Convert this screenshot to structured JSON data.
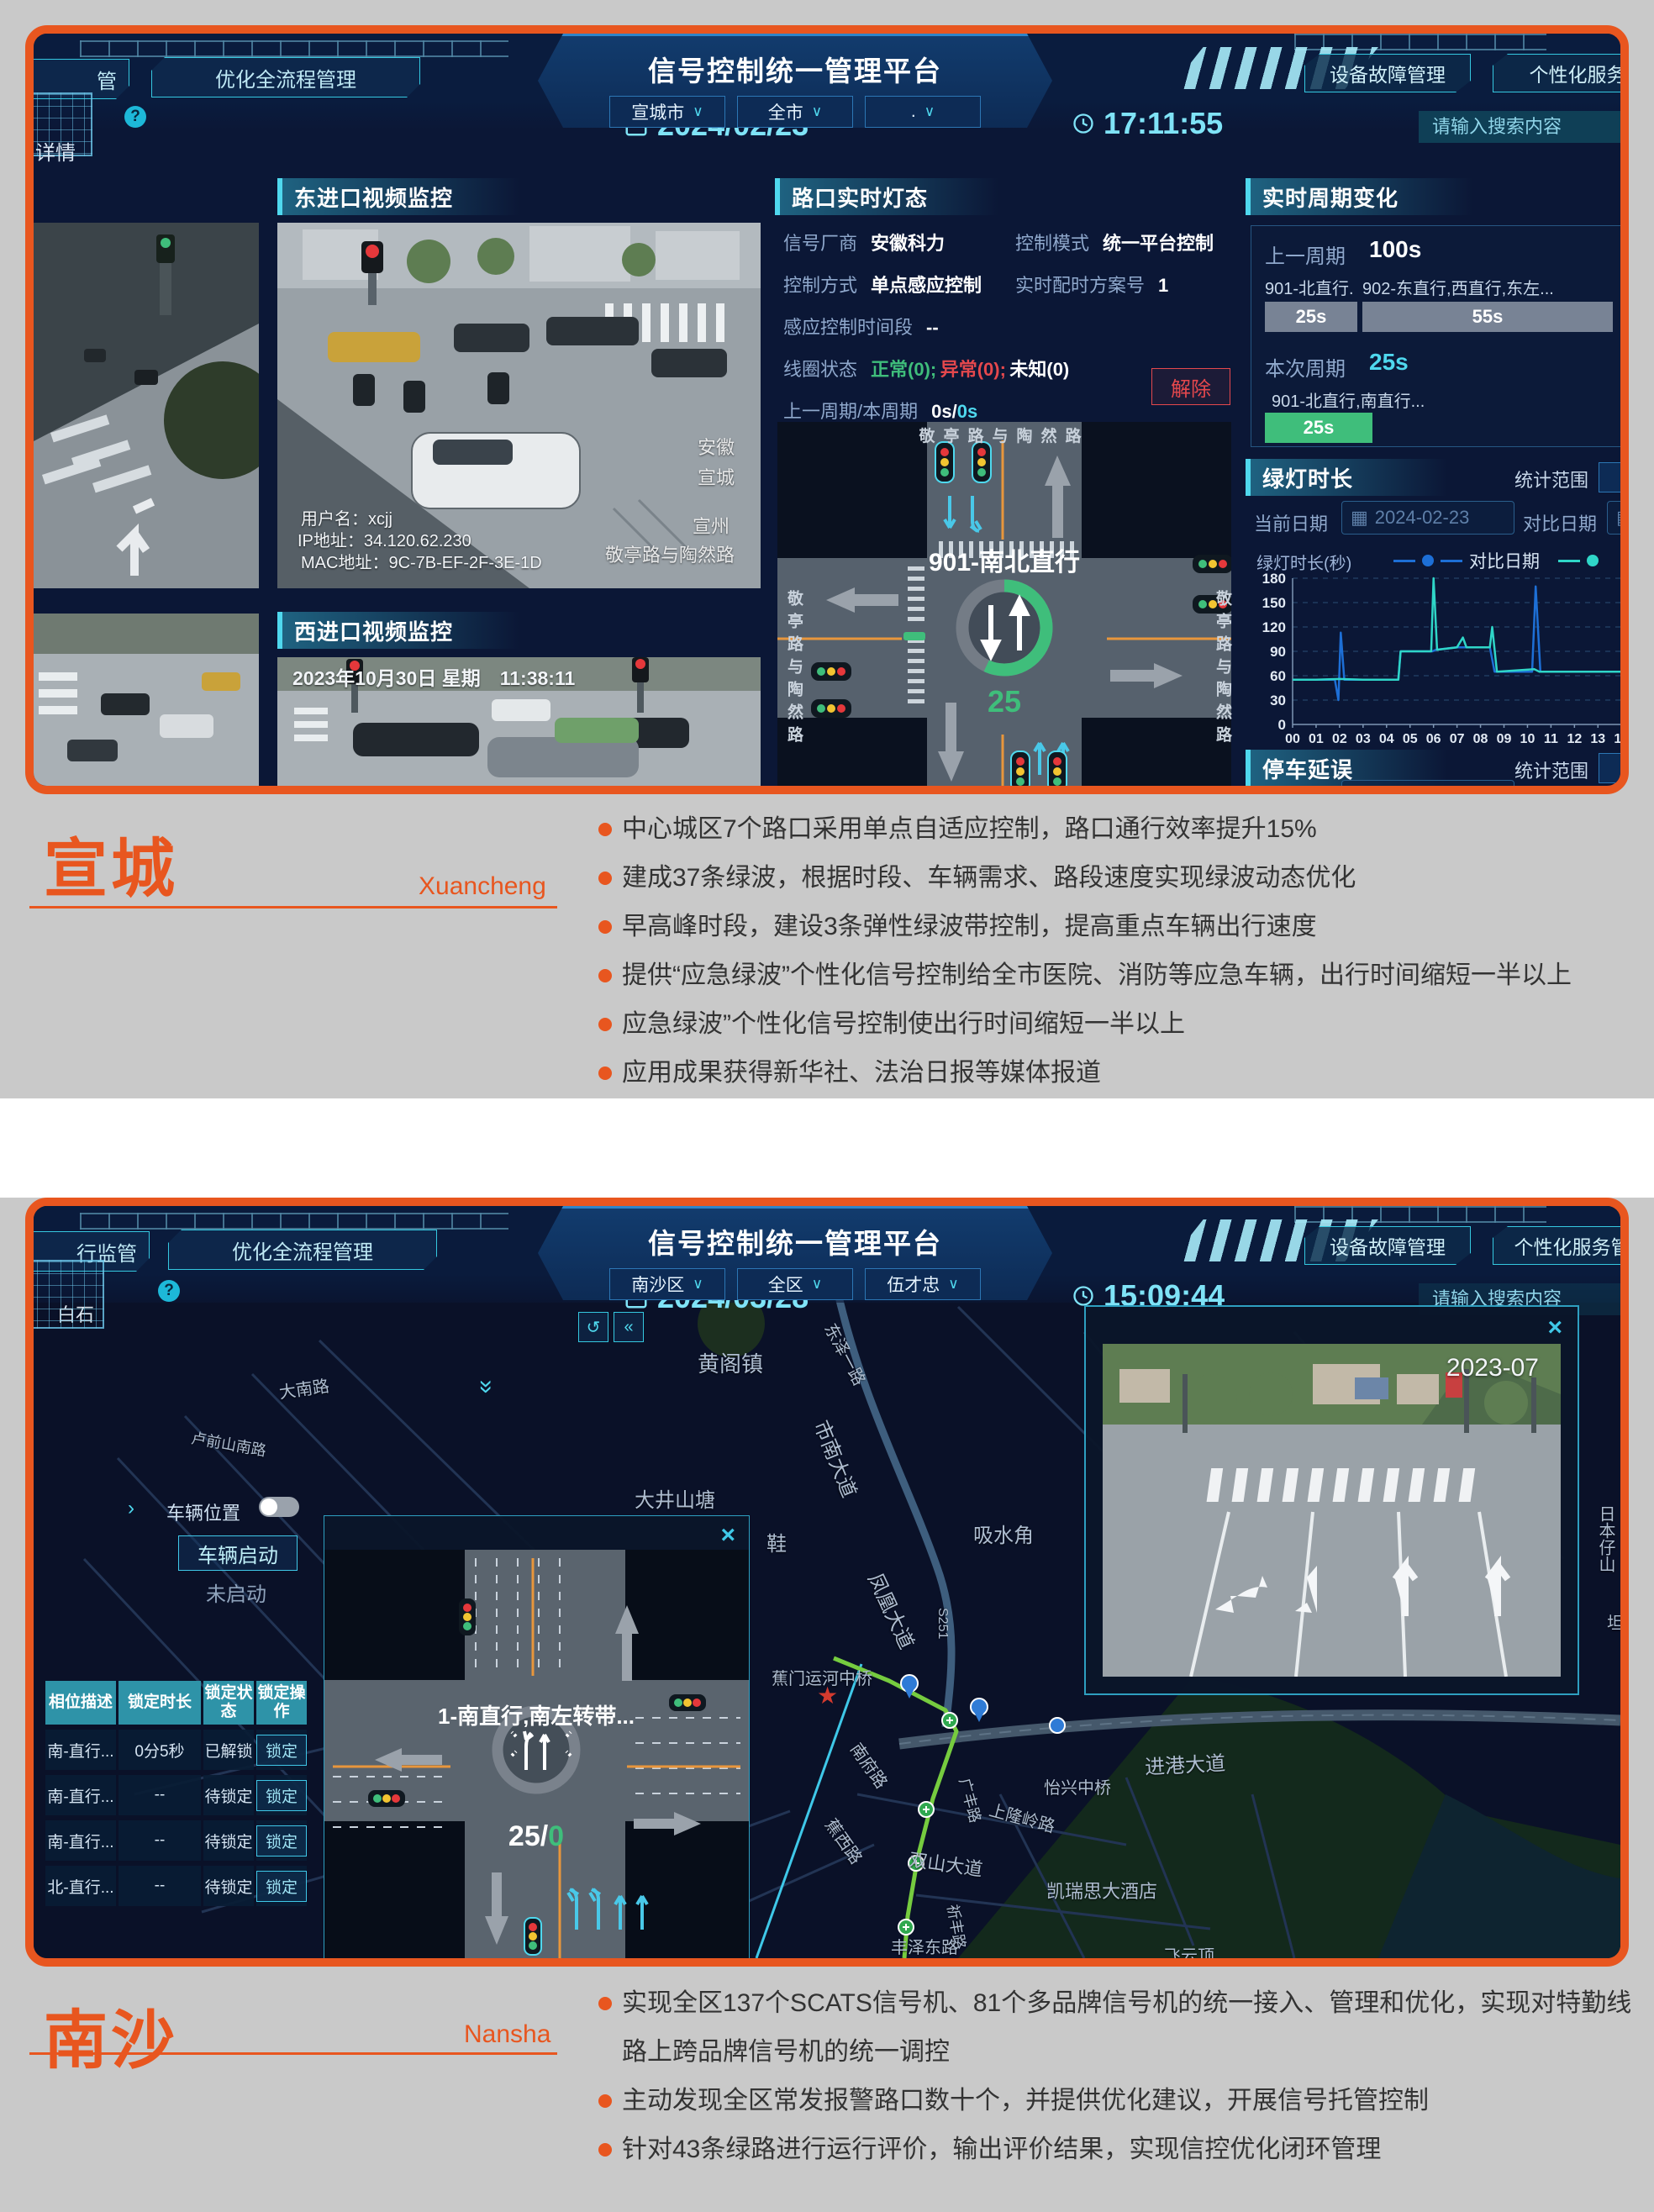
{
  "page": {
    "bg": "#C9C9C9",
    "accent": "#E8561F"
  },
  "sections": {
    "xuancheng": {
      "title": "宣城",
      "pinyin": "Xuancheng",
      "bullets": [
        "中心城区7个路口采用单点自适应控制，路口通行效率提升15%",
        "建成37条绿波，根据时段、车辆需求、路段速度实现绿波动态优化",
        "早高峰时段，建设3条弹性绿波带控制，提高重点车辆出行速度",
        "提供“应急绿波”个性化信号控制给全市医院、消防等应急车辆，出行时间缩短一半以上",
        "应急绿波”个性化信号控制使出行时间缩短一半以上",
        "应用成果获得新华社、法治日报等媒体报道"
      ]
    },
    "nansha": {
      "title": "南沙",
      "pinyin": "Nansha",
      "bullets": [
        "实现全区137个SCATS信号机、81个多品牌信号机的统一接入、管理和优化，实现对特勤线路上跨品牌信号机的统一调控",
        "主动发现全区常发报警路口数十个，并提供优化建议，开展信号托管控制",
        "针对43条绿路进行运行评价，输出评价结果，实现信控优化闭环管理"
      ]
    }
  },
  "dash1": {
    "header": {
      "tab_partial": "管",
      "tab_optimize": "优化全流程管理",
      "date": "2024/02/23",
      "title": "信号控制统一管理平台",
      "dropdowns": [
        "宣城市",
        "全市",
        "."
      ],
      "time": "17:11:55",
      "btn_device": "设备故障管理",
      "btn_personal": "个性化服务",
      "search_placeholder": "请输入搜索内容",
      "crumb_partial": "详情"
    },
    "videos": {
      "east_label": "东进口视频监控",
      "west_label": "西进口视频监控",
      "overlay_user": "用户名：xcjj",
      "overlay_ip": "IP地址：34.120.62.230",
      "overlay_mac": "MAC地址：9C-7B-EF-2F-3E-1D",
      "wm1": "安徽",
      "wm2": "宣城",
      "wm3": "宣州",
      "wm4": "敬亭路与陶然路",
      "west_timestamp": "2023年10月30日 星期　11:38:11"
    },
    "light_panel": {
      "title": "路口实时灯态",
      "vendor_label": "信号厂商",
      "vendor": "安徽科力",
      "mode_label": "控制模式",
      "mode": "统一平台控制",
      "method_label": "控制方式",
      "method": "单点感应控制",
      "plan_label": "实时配时方案号",
      "plan": "1",
      "period_label": "感应控制时间段",
      "period": "--",
      "coil_label": "线圈状态",
      "coil_normal": "正常(0);",
      "coil_abnormal": "异常(0);",
      "coil_unknown": "未知(0)",
      "cycle_label": "上一周期/本周期",
      "cycle_prev": "0s/",
      "cycle_cur": "0s",
      "release_btn": "解除",
      "junction": {
        "road_top": "敬亭路与陶然路",
        "road_left": "敬亭路与陶然路",
        "road_right": "敬亭路与陶然路",
        "phase": "901-南北直行",
        "countdown": "25"
      }
    },
    "cycle_panel": {
      "title": "实时周期变化",
      "prev_label": "上一周期",
      "prev_value": "100s",
      "bar1_name": "901-北直行...",
      "bar1_value": "25s",
      "bar2_name": "902-东直行,西直行,东左...",
      "bar2_value": "55s",
      "cur_label": "本次周期",
      "cur_value": "25s",
      "cur_phase": "901-北直行,南直行...",
      "cur_bar": "25s"
    },
    "green_panel": {
      "title": "绿灯时长",
      "scope_label": "统计范围",
      "cur_date_label": "当前日期",
      "cur_date": "2024-02-23",
      "cmp_date_label": "对比日期",
      "cmp_date": "2023-",
      "legend_cmp": "对比日期",
      "y_label": "绿灯时长(秒)"
    },
    "delay_panel": {
      "title": "停车延误",
      "scope_label": "统计范围",
      "cur_date_label": "当前日期",
      "cur_date": "2024-02-23",
      "cmp_date_label": "对比日期",
      "cmp_date": "2023-"
    }
  },
  "chart_data": {
    "type": "line",
    "title": "绿灯时长",
    "ylabel": "绿灯时长(秒)",
    "xlabel": "时(小时)",
    "ylim": [
      0,
      180
    ],
    "yticks": [
      0,
      30,
      60,
      90,
      120,
      150,
      180
    ],
    "xticks": [
      "00",
      "01",
      "02",
      "03",
      "04",
      "05",
      "06",
      "07",
      "08",
      "09",
      "10",
      "11",
      "12",
      "13",
      "14"
    ],
    "grid": true,
    "legend_position": "top-right",
    "series": [
      {
        "name": "对比日期",
        "color": "#1D6FD6",
        "points": [
          [
            0,
            55
          ],
          [
            1.8,
            55
          ],
          [
            1.95,
            30
          ],
          [
            2.05,
            113
          ],
          [
            2.2,
            55
          ],
          [
            4.5,
            55
          ],
          [
            4.6,
            90
          ],
          [
            5.95,
            90
          ],
          [
            6.1,
            92
          ],
          [
            7,
            95
          ],
          [
            8.4,
            95
          ],
          [
            8.6,
            65
          ],
          [
            10.2,
            65
          ],
          [
            10.35,
            170
          ],
          [
            10.55,
            65
          ],
          [
            12,
            65
          ],
          [
            14.4,
            65
          ]
        ]
      },
      {
        "name": "当前日期",
        "color": "#2FD6C8",
        "points": [
          [
            0,
            55
          ],
          [
            1,
            55
          ],
          [
            2,
            56
          ],
          [
            3,
            55
          ],
          [
            4.5,
            55
          ],
          [
            4.6,
            90
          ],
          [
            5.9,
            90
          ],
          [
            6,
            180
          ],
          [
            6.15,
            92
          ],
          [
            7,
            95
          ],
          [
            7.25,
            107
          ],
          [
            7.4,
            95
          ],
          [
            8.4,
            95
          ],
          [
            8.5,
            120
          ],
          [
            8.7,
            65
          ],
          [
            10.3,
            68
          ],
          [
            10.5,
            65
          ],
          [
            12,
            65
          ],
          [
            14.4,
            65
          ]
        ]
      }
    ]
  },
  "dash2": {
    "header": {
      "tab_partial": "行监管",
      "tab_optimize": "优化全流程管理",
      "date": "2024/03/28",
      "title": "信号控制统一管理平台",
      "dropdowns": [
        "南沙区",
        "全区",
        "伍才忠"
      ],
      "time": "15:09:44",
      "btn_device": "设备故障管理",
      "btn_personal": "个性化服务管理",
      "search_placeholder": "请输入搜索内容"
    },
    "sidebar": {
      "vehicle_pos": "车辆位置",
      "vehicle_start": "车辆启动",
      "not_started": "未启动",
      "undo_icon": "↺",
      "collapse_icon": "«",
      "chevrons": "«"
    },
    "table": {
      "headers": [
        "相位描述",
        "锁定时长",
        "锁定状态",
        "锁定操作"
      ],
      "rows": [
        [
          "南-直行...",
          "0分5秒",
          "已解锁",
          "锁定"
        ],
        [
          "南-直行...",
          "--",
          "待锁定",
          "锁定"
        ],
        [
          "南-直行...",
          "--",
          "待锁定",
          "锁定"
        ],
        [
          "北-直行...",
          "--",
          "待锁定",
          "锁定"
        ]
      ]
    },
    "popup": {
      "phase": "1-南直行,南左转带...",
      "countdown_white": "25/",
      "countdown_green": "0"
    },
    "video_popup": {
      "timestamp": "2023-07"
    },
    "map_labels": [
      {
        "t": "白石",
        "x": 28,
        "y": 112,
        "s": 22,
        "c": "#DFE8F2"
      },
      {
        "t": "黄阁镇",
        "x": 790,
        "y": 168,
        "s": 26
      },
      {
        "t": "大南路",
        "x": 292,
        "y": 206,
        "r": -8,
        "s": 20
      },
      {
        "t": "卢前山南路",
        "x": 188,
        "y": 262,
        "r": 10,
        "s": 18
      },
      {
        "t": "东泽一路",
        "x": 948,
        "y": 126,
        "r": 62,
        "s": 20
      },
      {
        "t": "市南大道",
        "x": 938,
        "y": 238,
        "r": 68,
        "s": 24
      },
      {
        "t": "大井山塘",
        "x": 715,
        "y": 330,
        "s": 24
      },
      {
        "t": "凤凰大道",
        "x": 1002,
        "y": 420,
        "r": 65,
        "s": 24
      },
      {
        "t": "吸水角",
        "x": 1118,
        "y": 372,
        "s": 24
      },
      {
        "t": "鞋",
        "x": 872,
        "y": 382,
        "s": 24
      },
      {
        "t": "S251",
        "x": 1072,
        "y": 478,
        "v": 1,
        "s": 16
      },
      {
        "t": "蕉门运河中桥",
        "x": 878,
        "y": 546,
        "s": 20
      },
      {
        "t": "南府路",
        "x": 978,
        "y": 626,
        "r": 55,
        "s": 20
      },
      {
        "t": "蕉西路",
        "x": 948,
        "y": 716,
        "r": 55,
        "s": 20
      },
      {
        "t": "双山大道",
        "x": 1042,
        "y": 760,
        "r": 8,
        "s": 22
      },
      {
        "t": "广丰路",
        "x": 1108,
        "y": 668,
        "r": 75,
        "s": 18
      },
      {
        "t": "上隆岭路",
        "x": 1138,
        "y": 702,
        "r": 15,
        "s": 20
      },
      {
        "t": "怡兴中桥",
        "x": 1202,
        "y": 676,
        "s": 20
      },
      {
        "t": "进港大道",
        "x": 1322,
        "y": 648,
        "r": -3,
        "s": 24
      },
      {
        "t": "凯瑞思大酒店",
        "x": 1205,
        "y": 798,
        "s": 22
      },
      {
        "t": "祈丰路",
        "x": 1094,
        "y": 818,
        "r": 80,
        "s": 18
      },
      {
        "t": "丰泽东路",
        "x": 1020,
        "y": 866,
        "s": 20
      },
      {
        "t": "飞云顶",
        "x": 1345,
        "y": 876,
        "s": 20
      },
      {
        "t": "日本仔山",
        "x": 1856,
        "y": 356,
        "v": 1,
        "s": 20
      },
      {
        "t": "坦",
        "x": 1872,
        "y": 480,
        "s": 20
      }
    ]
  }
}
